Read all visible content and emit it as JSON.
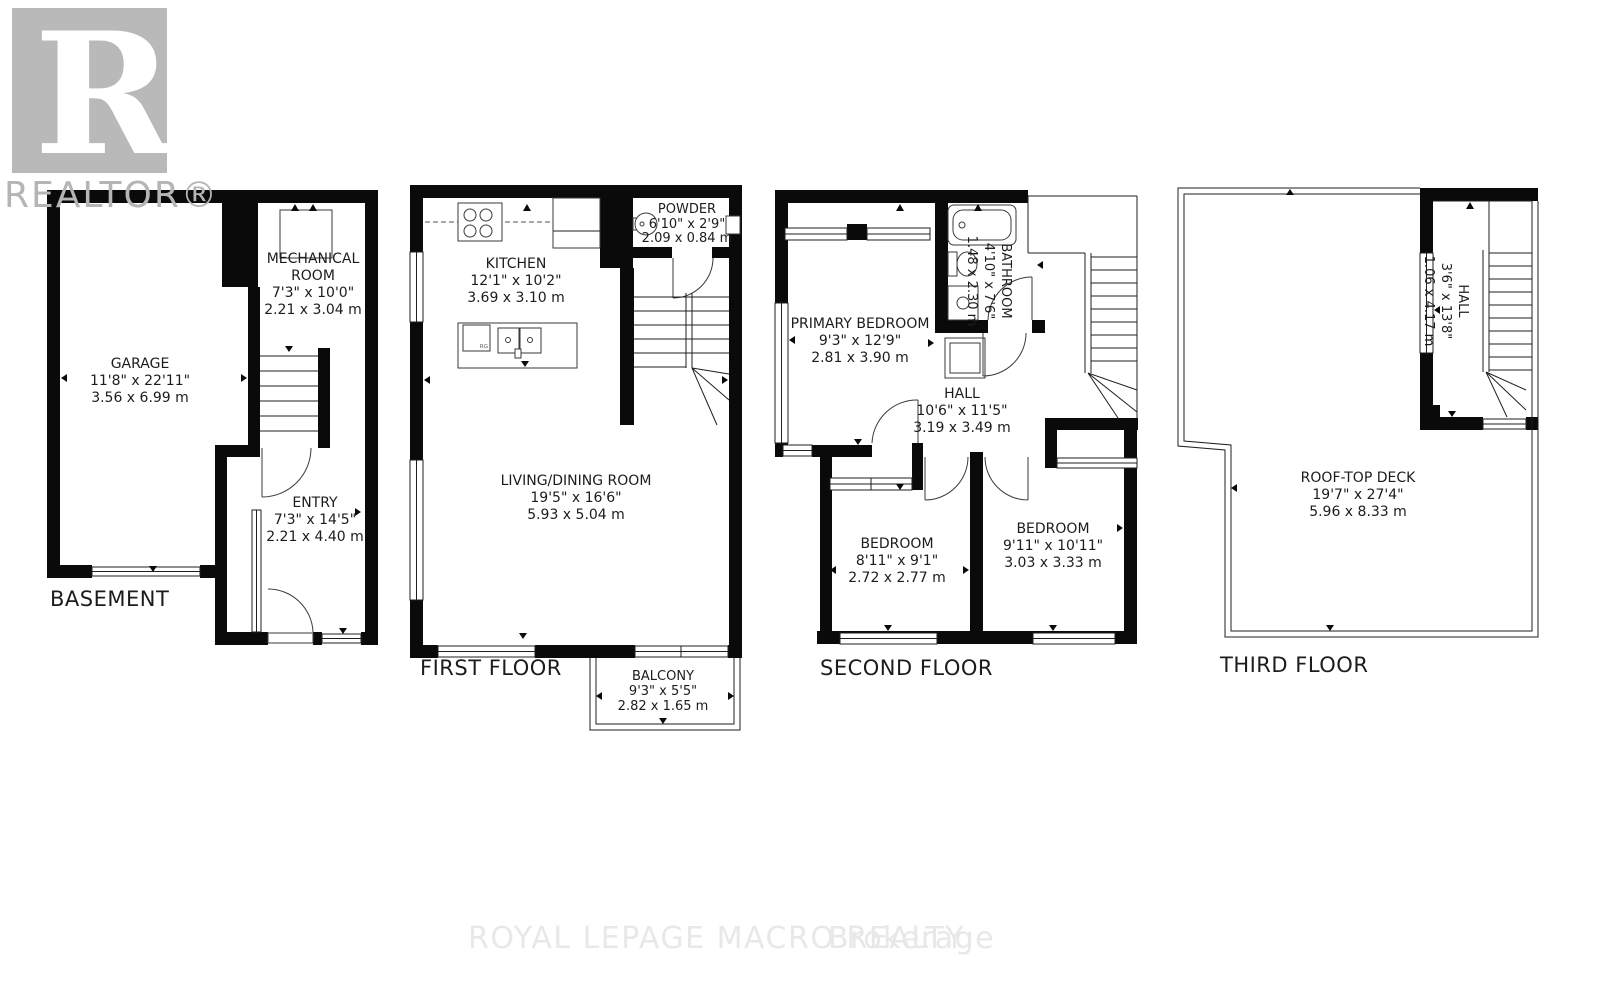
{
  "branding": {
    "logo_letter": "R",
    "logo_text": "REALTOR®",
    "watermark_main": "ROYAL LEPAGE MACRO REALTY",
    "watermark_suffix": "Brokerage"
  },
  "colors": {
    "wall": "#0a0a0a",
    "logo_gray": "#b9b9b9",
    "watermark_gray": "#e8e8e8"
  },
  "floors": [
    {
      "title": "BASEMENT",
      "rooms": [
        {
          "name": "GARAGE",
          "dims_ft": "11'8\" x 22'11\"",
          "dims_m": "3.56 x 6.99 m"
        },
        {
          "name": "MECHANICAL",
          "name2": "ROOM",
          "dims_ft": "7'3\" x 10'0\"",
          "dims_m": "2.21 x 3.04 m"
        },
        {
          "name": "ENTRY",
          "dims_ft": "7'3\" x 14'5\"",
          "dims_m": "2.21 x 4.40 m"
        }
      ]
    },
    {
      "title": "FIRST FLOOR",
      "island_tag": "RG",
      "rooms": [
        {
          "name": "KITCHEN",
          "dims_ft": "12'1\" x 10'2\"",
          "dims_m": "3.69 x 3.10 m"
        },
        {
          "name": "POWDER",
          "dims_ft": "6'10\" x 2'9\"",
          "dims_m": "2.09 x 0.84 m"
        },
        {
          "name": "LIVING/DINING ROOM",
          "dims_ft": "19'5\" x 16'6\"",
          "dims_m": "5.93 x 5.04 m"
        },
        {
          "name": "BALCONY",
          "dims_ft": "9'3\" x 5'5\"",
          "dims_m": "2.82 x 1.65 m"
        }
      ]
    },
    {
      "title": "SECOND FLOOR",
      "rooms": [
        {
          "name": "PRIMARY BEDROOM",
          "dims_ft": "9'3\" x 12'9\"",
          "dims_m": "2.81 x 3.90 m"
        },
        {
          "name": "BATHROOM",
          "dims_ft": "4'10\" x 7'6\"",
          "dims_m": "1.48 x 2.30 m"
        },
        {
          "name": "HALL",
          "dims_ft": "10'6\" x 11'5\"",
          "dims_m": "3.19 x 3.49 m"
        },
        {
          "name": "BEDROOM",
          "dims_ft": "8'11\" x 9'1\"",
          "dims_m": "2.72 x 2.77 m"
        },
        {
          "name": "BEDROOM",
          "dims_ft": "9'11\" x 10'11\"",
          "dims_m": "3.03 x 3.33 m"
        }
      ]
    },
    {
      "title": "THIRD FLOOR",
      "rooms": [
        {
          "name": "HALL",
          "dims_ft": "3'6\" x 13'8\"",
          "dims_m": "1.06 x 4.17 m"
        },
        {
          "name": "ROOF-TOP DECK",
          "dims_ft": "19'7\" x 27'4\"",
          "dims_m": "5.96 x 8.33 m"
        }
      ]
    }
  ]
}
